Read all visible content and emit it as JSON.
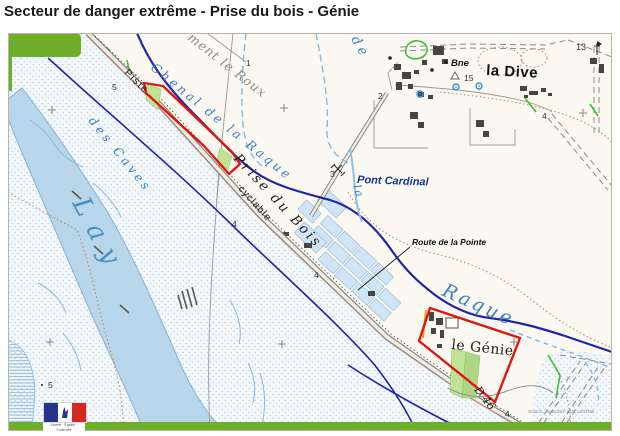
{
  "title": "Secteur de danger extrême - Prise du bois - Génie",
  "map": {
    "logo": {
      "motto": "Liberté · Égalité · Fraternité",
      "republic": "RÉPUBLIQUE FRANÇAISE"
    },
    "colors": {
      "water_text": "#3d7ec2",
      "channel_navy": "#2323a8",
      "danger_red": "#de1710",
      "frame_green": "#6fae28",
      "river_blue": "#b7d6ea",
      "road_gray": "#878780",
      "path_brown": "#c4876a",
      "hedge_green": "#3fbe2e"
    },
    "labels": [
      {
        "id": "chenal-de-la-raque",
        "text": "Chenal de la Raque",
        "x": 142,
        "y": 36,
        "rot": 39,
        "size": 12.5,
        "ls": 3,
        "fill": "#3d7ec2",
        "serif": 1,
        "italic": 1
      },
      {
        "id": "raque",
        "text": "Raque",
        "x": 433,
        "y": 262,
        "rot": 24,
        "size": 19,
        "ls": 3,
        "fill": "#3d7ec2",
        "serif": 1,
        "italic": 1
      },
      {
        "id": "lay-river",
        "text": "Lay",
        "x": 64,
        "y": 170,
        "rot": 62,
        "size": 26,
        "ls": 12,
        "fill": "#4a8ec2",
        "serif": 1,
        "italic": 1
      },
      {
        "id": "des-caves",
        "text": "des Caves",
        "x": 80,
        "y": 88,
        "rot": 51,
        "size": 12,
        "ls": 3.5,
        "fill": "#3d7ec2",
        "serif": 1,
        "italic": 1
      },
      {
        "id": "de-vertical",
        "text": "de",
        "x": 343,
        "y": 6,
        "rot": 60,
        "size": 13,
        "ls": 4,
        "fill": "#3d7ec2",
        "serif": 1,
        "italic": 1
      },
      {
        "id": "la-vertical",
        "text": "la",
        "x": 345,
        "y": 153,
        "rot": 73,
        "size": 11,
        "ls": 2,
        "fill": "#3d7ec2",
        "serif": 1,
        "italic": 1
      },
      {
        "id": "ment-le-roux",
        "text": "ment le Roux",
        "x": 179,
        "y": 6,
        "rot": 38,
        "size": 12.5,
        "ls": 1,
        "fill": "#8a8a8a",
        "serif": 1,
        "italic": 1
      },
      {
        "id": "pont-cardinal",
        "text": "Pont Cardinal",
        "x": 349,
        "y": 150,
        "rot": 2,
        "size": 11,
        "fill": "#16368c",
        "bold": 1,
        "italic": 1
      },
      {
        "id": "route-de-la-pointe",
        "text": "Route de la Pointe",
        "x": 404,
        "y": 212,
        "rot": 0,
        "size": 8.5,
        "fill": "#111111",
        "bold": 1,
        "italic": 1
      },
      {
        "id": "la-dive",
        "text": "la Dive",
        "x": 478,
        "y": 42,
        "rot": 3,
        "size": 15,
        "ls": 0.5,
        "fill": "#111111",
        "bold": 1
      },
      {
        "id": "le-genie",
        "text": "le Génie",
        "x": 443,
        "y": 316,
        "rot": 6,
        "size": 14,
        "ls": 0.5,
        "fill": "#222222",
        "serif": 1
      },
      {
        "id": "bne",
        "text": "Bne",
        "x": 443,
        "y": 33,
        "rot": 0,
        "size": 9.5,
        "fill": "#111111",
        "bold": 1,
        "italic": 1
      },
      {
        "id": "pt-15",
        "text": "15",
        "x": 456,
        "y": 48,
        "rot": 0,
        "size": 8.5,
        "fill": "#333333"
      },
      {
        "id": "prise-du-bois",
        "text": "Prise du Bois",
        "x": 225,
        "y": 126,
        "rot": 47,
        "size": 13.5,
        "ls": 2.5,
        "fill": "#222222",
        "serif": 1,
        "italic": 1
      },
      {
        "id": "piste",
        "text": "Piste",
        "x": 116,
        "y": 40,
        "rot": 45,
        "size": 10,
        "ls": 1.5,
        "fill": "#222222"
      },
      {
        "id": "cyclable",
        "text": "cyclable",
        "x": 230,
        "y": 156,
        "rot": 48,
        "size": 10,
        "ls": 1,
        "fill": "#222222"
      },
      {
        "id": "d46",
        "text": "D 46",
        "x": 466,
        "y": 357,
        "rot": 52,
        "size": 11,
        "fill": "#222222",
        "serif": 1,
        "italic": 1
      },
      {
        "id": "n5-road",
        "text": "5",
        "x": 104,
        "y": 57,
        "rot": 0,
        "size": 8.5,
        "fill": "#333333"
      },
      {
        "id": "n1",
        "text": "1",
        "x": 238,
        "y": 33,
        "rot": 0,
        "size": 8.5,
        "fill": "#333333"
      },
      {
        "id": "n2",
        "text": "2",
        "x": 370,
        "y": 66,
        "rot": 0,
        "size": 8.5,
        "fill": "#333333"
      },
      {
        "id": "n3",
        "text": "3",
        "x": 322,
        "y": 144,
        "rot": 0,
        "size": 8.5,
        "fill": "#333333"
      },
      {
        "id": "n4-a",
        "text": "4",
        "x": 224,
        "y": 194,
        "rot": 0,
        "size": 8.5,
        "fill": "#333333"
      },
      {
        "id": "n4-b",
        "text": "4",
        "x": 306,
        "y": 245,
        "rot": 0,
        "size": 8.5,
        "fill": "#333333"
      },
      {
        "id": "n4-dive",
        "text": "4",
        "x": 534,
        "y": 86,
        "rot": 0,
        "size": 8.5,
        "fill": "#333333"
      },
      {
        "id": "n4-genie",
        "text": "4",
        "x": 497,
        "y": 384,
        "rot": 0,
        "size": 8.5,
        "fill": "#333333"
      },
      {
        "id": "n5-marsh",
        "text": "5",
        "x": 40,
        "y": 355,
        "rot": 0,
        "size": 8.5,
        "fill": "#333333"
      },
      {
        "id": "n13",
        "text": "13",
        "x": 568,
        "y": 17,
        "rot": 0,
        "size": 9,
        "fill": "#333333"
      },
      {
        "id": "attribution",
        "text": "Source : Scan25® IGN, L93TM5",
        "x": 520,
        "y": 380,
        "rot": 0,
        "size": 4.6,
        "fill": "#8a8a88"
      }
    ]
  }
}
